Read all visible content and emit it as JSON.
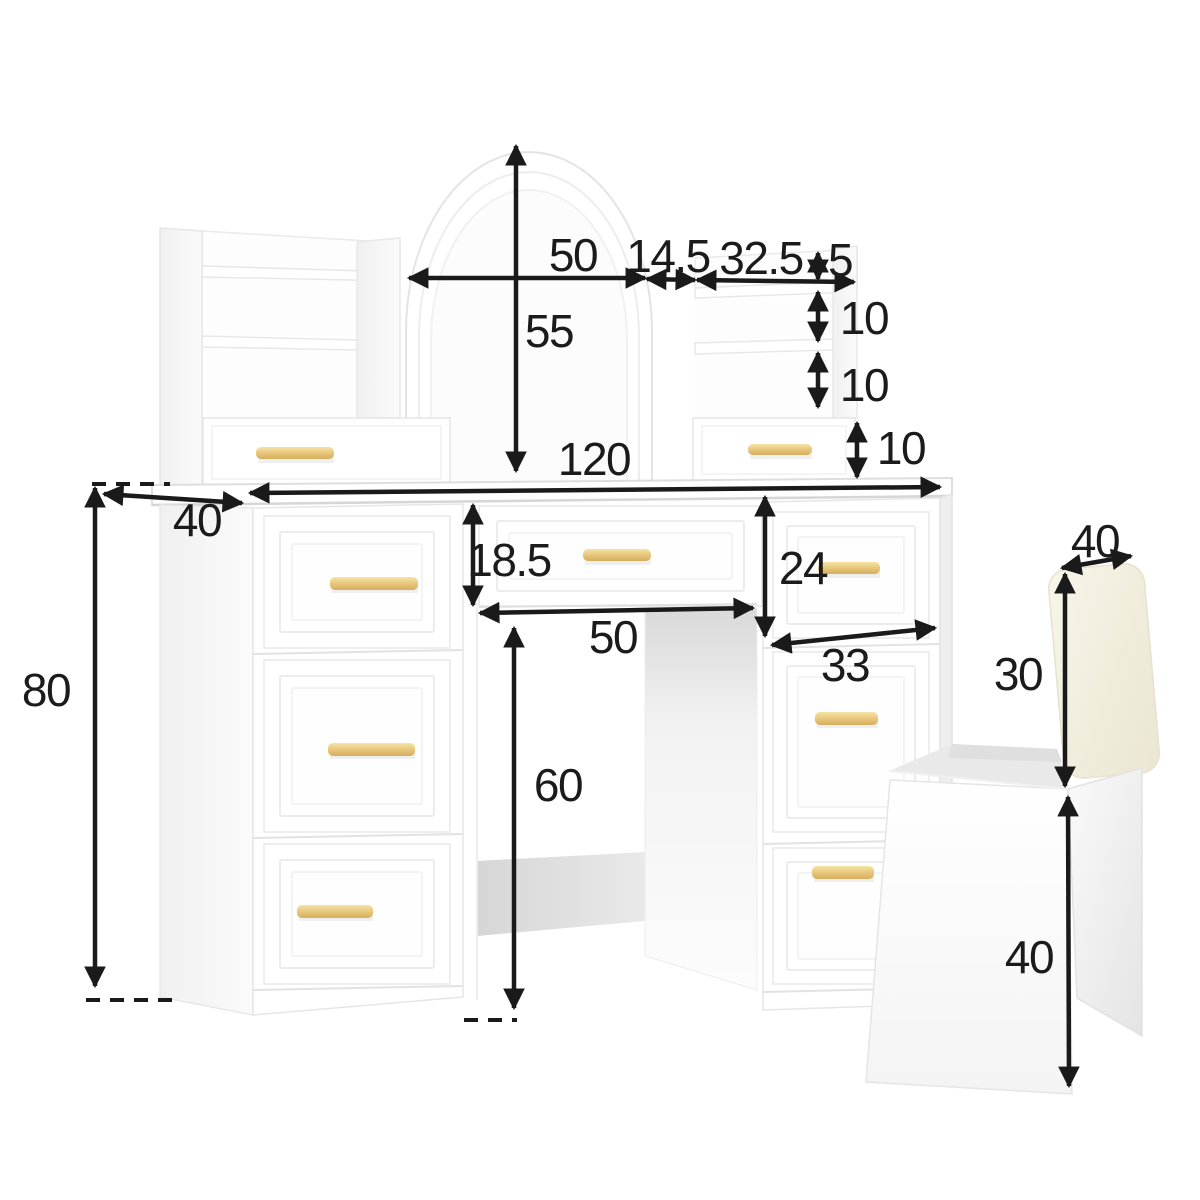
{
  "diagram": {
    "kind": "furniture-dimension-diagram"
  },
  "dimensions": {
    "mirror_width": "50",
    "mirror_height": "55",
    "mirror_to_shelf_gap": "14.5",
    "right_shelf_width": "32.5",
    "shelf_top_lip_height": "5",
    "shelf_gap_upper": "10",
    "shelf_gap_lower": "10",
    "hutch_drawer_height": "10",
    "desktop_width": "120",
    "desktop_depth": "40",
    "desk_height": "80",
    "middle_drawer_height": "18.5",
    "knee_space_width": "50",
    "side_drawer_height": "24",
    "right_pedestal_width": "33",
    "knee_space_height": "60",
    "stool_backrest_height": "30",
    "stool_seat_depth": "40",
    "stool_height": "40"
  },
  "colors": {
    "dimension_line": "#1a1a1a",
    "handle_gold": "#e2c172",
    "cushion_cream": "#f3efe0",
    "furniture_white": "#ffffff",
    "shadow_gray": "#d9d9d9"
  }
}
